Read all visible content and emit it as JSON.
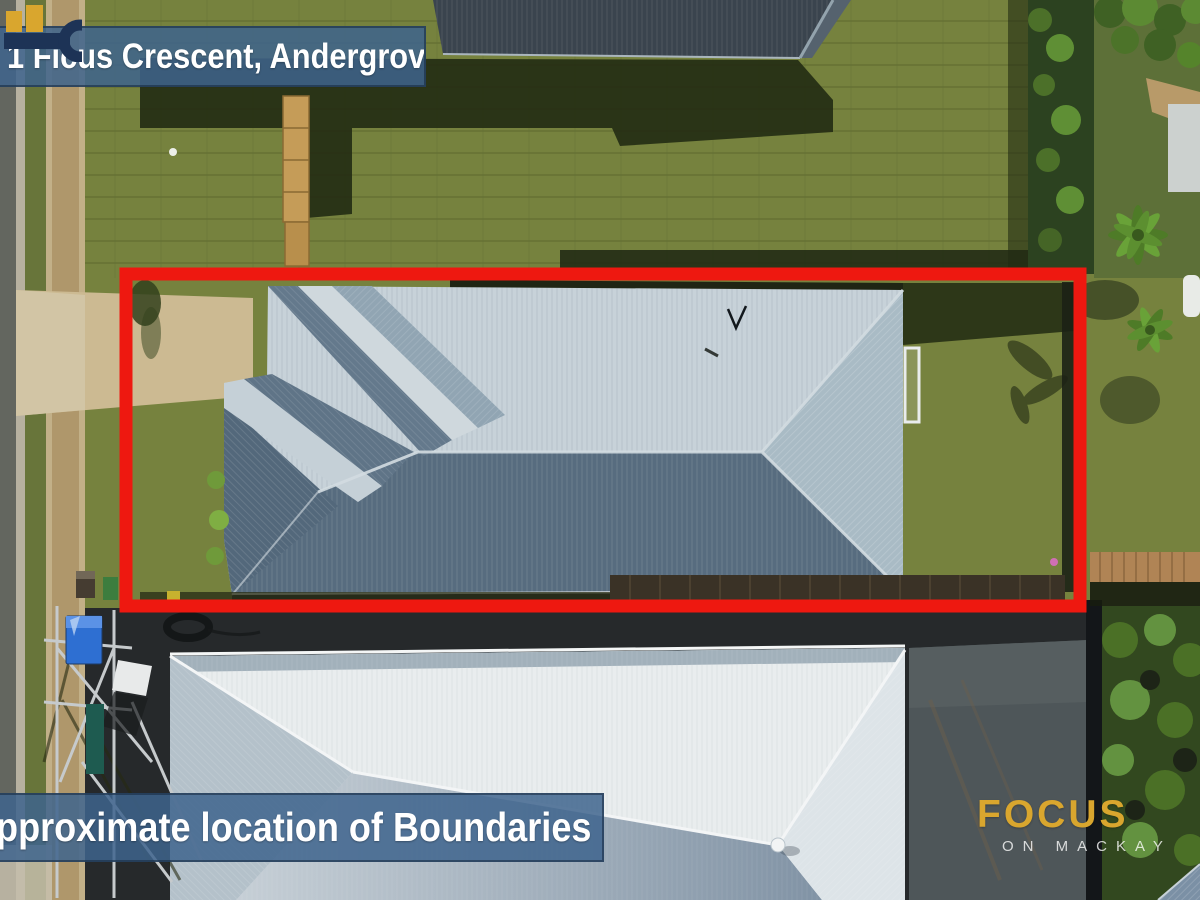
{
  "banners": {
    "address": "1 Ficus Crescent, Andergrove",
    "caption": "Approximate location of Boundaries"
  },
  "branding": {
    "name": "FOCUS",
    "tagline": "ON MACKAY",
    "icon": "key-icon"
  },
  "colors": {
    "banner-blue": "#3e648d",
    "boundary-red": "#ee1810",
    "logo-gold": "#d9a62e",
    "logo-navy": "#1d3356"
  }
}
